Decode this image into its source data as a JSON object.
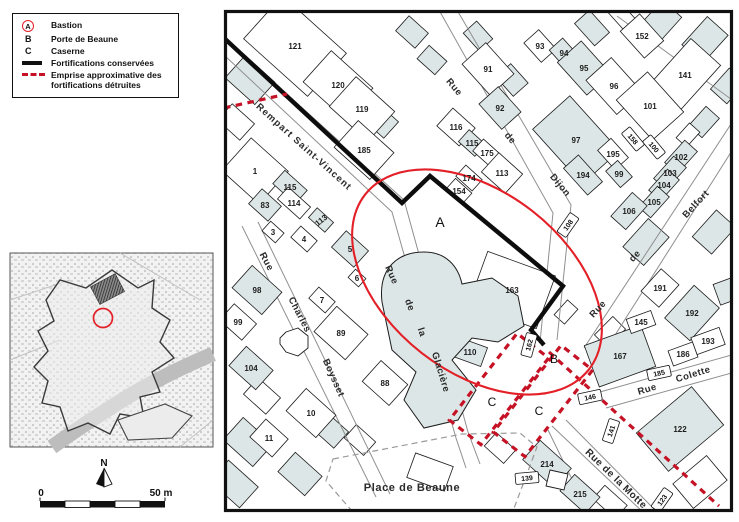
{
  "colors": {
    "shade": "#dde6e6",
    "red_line": "#e32028",
    "red_dash": "#c51225",
    "wall": "#0d0d0d"
  },
  "legend": {
    "items": [
      {
        "key": "A",
        "label": "Bastion"
      },
      {
        "key": "B",
        "label": "Porte de Beaune"
      },
      {
        "key": "C",
        "label": "Caserne"
      },
      {
        "key": "",
        "label": "Fortifications conservées"
      },
      {
        "key": "",
        "label": "Emprise approximative des fortifications détruites"
      }
    ]
  },
  "north": {
    "label": "N"
  },
  "scalebar": {
    "start": "0",
    "end": "50 m"
  },
  "map": {
    "letters": [
      {
        "t": "A",
        "x": 440,
        "y": 227,
        "fs": 14
      },
      {
        "t": "B",
        "x": 554,
        "y": 363,
        "fs": 12
      },
      {
        "t": "C",
        "x": 492,
        "y": 406,
        "fs": 12
      },
      {
        "t": "C",
        "x": 539,
        "y": 415,
        "fs": 12
      }
    ],
    "parcels": [
      {
        "n": "121",
        "x": 295,
        "y": 46,
        "w": 86,
        "h": 58,
        "r": 42,
        "s": 0
      },
      {
        "n": "120",
        "x": 338,
        "y": 85,
        "w": 56,
        "h": 42,
        "r": 42,
        "s": 0
      },
      {
        "n": "119",
        "x": 362,
        "y": 109,
        "w": 52,
        "h": 40,
        "r": 42,
        "s": 0
      },
      {
        "n": "185",
        "x": 364,
        "y": 150,
        "w": 48,
        "h": 36,
        "r": 42,
        "s": 0
      },
      {
        "n": "116",
        "x": 456,
        "y": 127,
        "w": 30,
        "h": 24,
        "r": 42,
        "s": 0
      },
      {
        "n": "115",
        "x": 472,
        "y": 143,
        "w": 22,
        "h": 16,
        "r": 42,
        "s": 1
      },
      {
        "n": "175",
        "x": 487,
        "y": 153,
        "w": 24,
        "h": 16,
        "r": 42,
        "s": 0
      },
      {
        "n": "174",
        "x": 469,
        "y": 178,
        "w": 22,
        "h": 15,
        "r": 42,
        "s": 0
      },
      {
        "n": "154",
        "x": 459,
        "y": 191,
        "w": 22,
        "h": 14,
        "r": 42,
        "s": 0
      },
      {
        "n": "113",
        "x": 502,
        "y": 173,
        "w": 32,
        "h": 26,
        "r": 42,
        "s": 0
      },
      {
        "n": "91",
        "x": 488,
        "y": 69,
        "w": 42,
        "h": 32,
        "r": 48,
        "s": 0
      },
      {
        "n": "92",
        "x": 500,
        "y": 108,
        "w": 34,
        "h": 26,
        "r": 48,
        "s": 1
      },
      {
        "n": "93",
        "x": 540,
        "y": 46,
        "w": 26,
        "h": 20,
        "r": 48,
        "s": 0
      },
      {
        "n": "94",
        "x": 564,
        "y": 53,
        "w": 24,
        "h": 18,
        "r": 48,
        "s": 1
      },
      {
        "n": "95",
        "x": 584,
        "y": 68,
        "w": 44,
        "h": 32,
        "r": 48,
        "s": 1
      },
      {
        "n": "96",
        "x": 614,
        "y": 86,
        "w": 46,
        "h": 34,
        "r": 48,
        "s": 0
      },
      {
        "n": "97",
        "x": 576,
        "y": 140,
        "w": 74,
        "h": 50,
        "r": 48,
        "s": 1
      },
      {
        "n": "195",
        "x": 613,
        "y": 154,
        "w": 26,
        "h": 18,
        "r": 48,
        "s": 0
      },
      {
        "n": "99",
        "x": 619,
        "y": 174,
        "w": 22,
        "h": 16,
        "r": 48,
        "s": 1
      },
      {
        "n": "194",
        "x": 583,
        "y": 175,
        "w": 36,
        "h": 20,
        "r": 48,
        "s": 1
      },
      {
        "n": "152",
        "x": 642,
        "y": 36,
        "w": 36,
        "h": 26,
        "r": 48,
        "s": 0
      },
      {
        "n": "141",
        "x": 685,
        "y": 75,
        "w": 62,
        "h": 40,
        "r": -48,
        "s": 0
      },
      {
        "n": "101",
        "x": 650,
        "y": 106,
        "w": 54,
        "h": 42,
        "r": 48,
        "s": 0
      },
      {
        "n": "102",
        "x": 681,
        "y": 157,
        "w": 30,
        "h": 17,
        "r": -48,
        "s": 1
      },
      {
        "n": "103",
        "x": 670,
        "y": 173,
        "w": 30,
        "h": 17,
        "r": -48,
        "s": 1
      },
      {
        "n": "104",
        "x": 664,
        "y": 185,
        "w": 28,
        "h": 16,
        "r": -48,
        "s": 1
      },
      {
        "n": "105",
        "x": 654,
        "y": 202,
        "w": 28,
        "h": 16,
        "r": -48,
        "s": 1
      },
      {
        "n": "106",
        "x": 629,
        "y": 211,
        "w": 32,
        "h": 20,
        "r": -48,
        "s": 1
      },
      {
        "n": "163",
        "x": 512,
        "y": 290,
        "w": 72,
        "h": 56,
        "r": 20,
        "s": 0
      },
      {
        "n": "110",
        "x": 470,
        "y": 352,
        "w": 30,
        "h": 20,
        "r": 20,
        "s": 1
      },
      {
        "n": "1",
        "x": 255,
        "y": 171,
        "w": 50,
        "h": 44,
        "r": 42,
        "s": 0
      },
      {
        "n": "115",
        "x": 290,
        "y": 187,
        "w": 30,
        "h": 18,
        "r": 42,
        "s": 1
      },
      {
        "n": "83",
        "x": 265,
        "y": 205,
        "w": 26,
        "h": 20,
        "r": 42,
        "s": 1
      },
      {
        "n": "114",
        "x": 294,
        "y": 203,
        "w": 30,
        "h": 16,
        "r": 42,
        "s": 0
      },
      {
        "n": "3",
        "x": 273,
        "y": 232,
        "w": 18,
        "h": 13,
        "r": 42,
        "s": 0
      },
      {
        "n": "4",
        "x": 304,
        "y": 239,
        "w": 22,
        "h": 15,
        "r": 42,
        "s": 0
      },
      {
        "n": "113",
        "x": 321,
        "y": 220,
        "w": 22,
        "h": 13,
        "r": 42,
        "s": 1,
        "lr": -38
      },
      {
        "n": "5",
        "x": 350,
        "y": 249,
        "w": 30,
        "h": 22,
        "r": 42,
        "s": 1
      },
      {
        "n": "6",
        "x": 357,
        "y": 278,
        "w": 14,
        "h": 11,
        "r": 42,
        "s": 0
      },
      {
        "n": "7",
        "x": 322,
        "y": 300,
        "w": 22,
        "h": 15,
        "r": 42,
        "s": 0
      },
      {
        "n": "98",
        "x": 257,
        "y": 290,
        "w": 40,
        "h": 30,
        "r": 42,
        "s": 1
      },
      {
        "n": "99",
        "x": 238,
        "y": 322,
        "w": 30,
        "h": 22,
        "r": 42,
        "s": 0
      },
      {
        "n": "89",
        "x": 341,
        "y": 333,
        "w": 42,
        "h": 34,
        "r": 42,
        "s": 0
      },
      {
        "n": "104",
        "x": 251,
        "y": 368,
        "w": 36,
        "h": 26,
        "r": 42,
        "s": 1
      },
      {
        "n": "10",
        "x": 311,
        "y": 413,
        "w": 40,
        "h": 30,
        "r": 42,
        "s": 0
      },
      {
        "n": "11",
        "x": 269,
        "y": 438,
        "w": 30,
        "h": 24,
        "r": 42,
        "s": 0
      },
      {
        "n": "88",
        "x": 385,
        "y": 383,
        "w": 36,
        "h": 28,
        "r": 42,
        "s": 0
      },
      {
        "n": "167",
        "x": 620,
        "y": 356,
        "w": 60,
        "h": 44,
        "r": -20,
        "s": 1
      },
      {
        "n": "145",
        "x": 641,
        "y": 322,
        "w": 26,
        "h": 15,
        "r": -20,
        "s": 0
      },
      {
        "n": "191",
        "x": 660,
        "y": 288,
        "w": 30,
        "h": 24,
        "r": -48,
        "s": 0
      },
      {
        "n": "192",
        "x": 692,
        "y": 313,
        "w": 44,
        "h": 34,
        "r": -48,
        "s": 1
      },
      {
        "n": "193",
        "x": 708,
        "y": 341,
        "w": 30,
        "h": 18,
        "r": -20,
        "s": 0
      },
      {
        "n": "186",
        "x": 683,
        "y": 354,
        "w": 26,
        "h": 16,
        "r": -20,
        "s": 0
      },
      {
        "n": "122",
        "x": 680,
        "y": 429,
        "w": 72,
        "h": 50,
        "r": -40,
        "s": 1
      },
      {
        "n": "214",
        "x": 547,
        "y": 464,
        "w": 42,
        "h": 26,
        "r": 42,
        "s": 1
      },
      {
        "n": "215",
        "x": 580,
        "y": 494,
        "w": 34,
        "h": 22,
        "r": 42,
        "s": 1
      }
    ],
    "boxed": [
      {
        "t": "108",
        "x": 568,
        "y": 225,
        "r": -55
      },
      {
        "t": "158",
        "x": 633,
        "y": 139,
        "r": 50
      },
      {
        "t": "100",
        "x": 654,
        "y": 147,
        "r": 50
      },
      {
        "t": "162",
        "x": 529,
        "y": 345,
        "r": -75
      },
      {
        "t": "146",
        "x": 590,
        "y": 397,
        "r": -12
      },
      {
        "t": "141",
        "x": 611,
        "y": 431,
        "r": -72
      },
      {
        "t": "185",
        "x": 659,
        "y": 373,
        "r": -12
      },
      {
        "t": "139",
        "x": 527,
        "y": 478,
        "r": -5
      },
      {
        "t": "123",
        "x": 662,
        "y": 500,
        "r": -55
      }
    ],
    "streets": [
      {
        "t": "Rempart Saint-Vincent",
        "x": 302,
        "y": 149,
        "r": 42,
        "fs": 9.5,
        "ls": 1.1
      },
      {
        "t": "Rue",
        "x": 452,
        "y": 89,
        "r": 50
      },
      {
        "t": "de",
        "x": 508,
        "y": 140,
        "r": 50
      },
      {
        "t": "Dijon",
        "x": 558,
        "y": 187,
        "r": 50
      },
      {
        "t": "Rue",
        "x": 600,
        "y": 311,
        "r": -47
      },
      {
        "t": "de",
        "x": 637,
        "y": 258,
        "r": -47
      },
      {
        "t": "Belfort",
        "x": 698,
        "y": 206,
        "r": -47
      },
      {
        "t": "Rue",
        "x": 264,
        "y": 263,
        "r": 62
      },
      {
        "t": "Charles",
        "x": 297,
        "y": 316,
        "r": 63
      },
      {
        "t": "Boysset",
        "x": 331,
        "y": 379,
        "r": 66
      },
      {
        "t": "Rue",
        "x": 389,
        "y": 276,
        "r": 66
      },
      {
        "t": "de",
        "x": 407,
        "y": 306,
        "r": 70
      },
      {
        "t": "la",
        "x": 419,
        "y": 333,
        "r": 72
      },
      {
        "t": "Glacière",
        "x": 438,
        "y": 373,
        "r": 73
      },
      {
        "t": "Rue",
        "x": 648,
        "y": 392,
        "r": -17
      },
      {
        "t": "Colette",
        "x": 694,
        "y": 377,
        "r": -17
      },
      {
        "t": "Rue de la Motte",
        "x": 614,
        "y": 481,
        "r": 44,
        "fs": 10
      },
      {
        "t": "Place de Beaune",
        "x": 412,
        "y": 491,
        "r": 0,
        "fs": 11,
        "ls": 0.6
      }
    ]
  }
}
